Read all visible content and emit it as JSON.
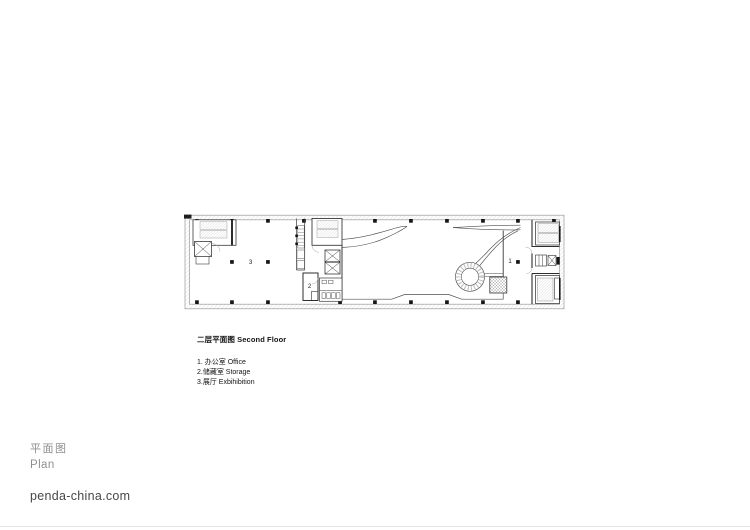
{
  "caption": {
    "title": "二层平面图 Second Floor",
    "items": [
      "1. 办公室 Office",
      "2.储藏室 Storage",
      "3.展厅 Exbihibition"
    ]
  },
  "plan_labels": {
    "office": "1",
    "storage": "2",
    "exhibition": "3"
  },
  "footer": {
    "label_cn": "平面图",
    "label_en": "Plan",
    "website": "penda-china.com"
  },
  "colors": {
    "ink": "#3a3a3a",
    "wall_hatch": "#c9c9c9",
    "muted_text": "#8f8f8f",
    "site_text": "#474747",
    "rule": "#e6e6e6",
    "background": "#ffffff"
  }
}
